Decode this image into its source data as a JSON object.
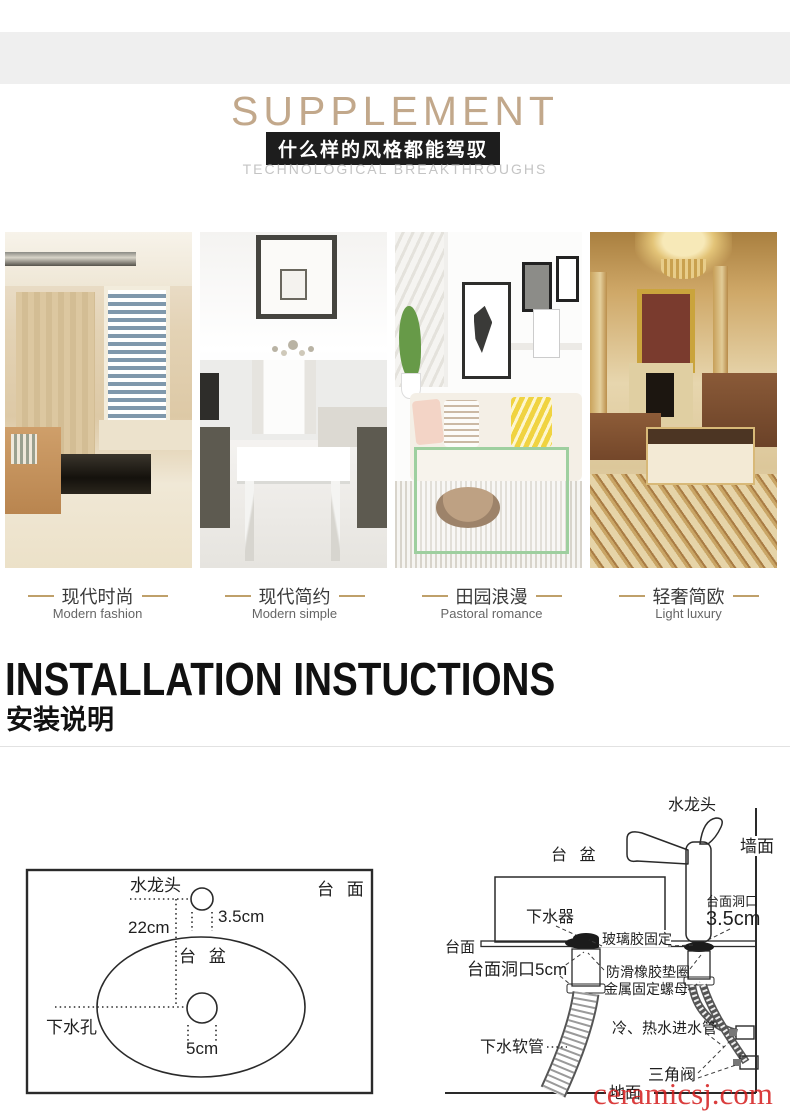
{
  "header": {
    "title": "SUPPLEMENT",
    "banner_cn": "什么样的风格都能驾驭",
    "subtitle_en": "TECHNOLOGICAL BREAKTHROUGHS"
  },
  "styles": [
    {
      "cn": "现代时尚",
      "en": "Modern fashion"
    },
    {
      "cn": "现代简约",
      "en": "Modern simple"
    },
    {
      "cn": "田园浪漫",
      "en": "Pastoral romance"
    },
    {
      "cn": "轻奢简欧",
      "en": "Light luxury"
    }
  ],
  "installation": {
    "title_en": "INSTALLATION INSTUCTIONS",
    "title_cn": "安装说明"
  },
  "top_view": {
    "countertop": "台 面",
    "faucet": "水龙头",
    "basin": "台 盆",
    "drain_hole": "下水孔",
    "faucet_hole_width": "3.5cm",
    "faucet_to_drain": "22cm",
    "drain_hole_width": "5cm"
  },
  "side_view": {
    "faucet": "水龙头",
    "wall": "墙面",
    "basin": "台 盆",
    "drain_fitting": "下水器",
    "silicone_fix": "玻璃胶固定",
    "countertop": "台面",
    "hole_label": "台面洞口",
    "hole_dim": "3.5cm",
    "drain_hole": "台面洞口5cm",
    "rubber_washer": "防滑橡胶垫圈",
    "metal_nut": "金属固定螺母",
    "inlet_pipes": "冷、热水进水管",
    "drain_hose": "下水软管",
    "angle_valve": "三角阀",
    "floor": "地面"
  },
  "watermark": "ceramicsj.com",
  "colors": {
    "accent_tan": "#c2a88b",
    "dash_gold": "#bfa06a",
    "banner_bg": "#1d1d1d",
    "subtitle_gray": "#c4c4c4",
    "watermark_red": "#d41c1c",
    "diagram_ink": "#2a2a2a"
  }
}
